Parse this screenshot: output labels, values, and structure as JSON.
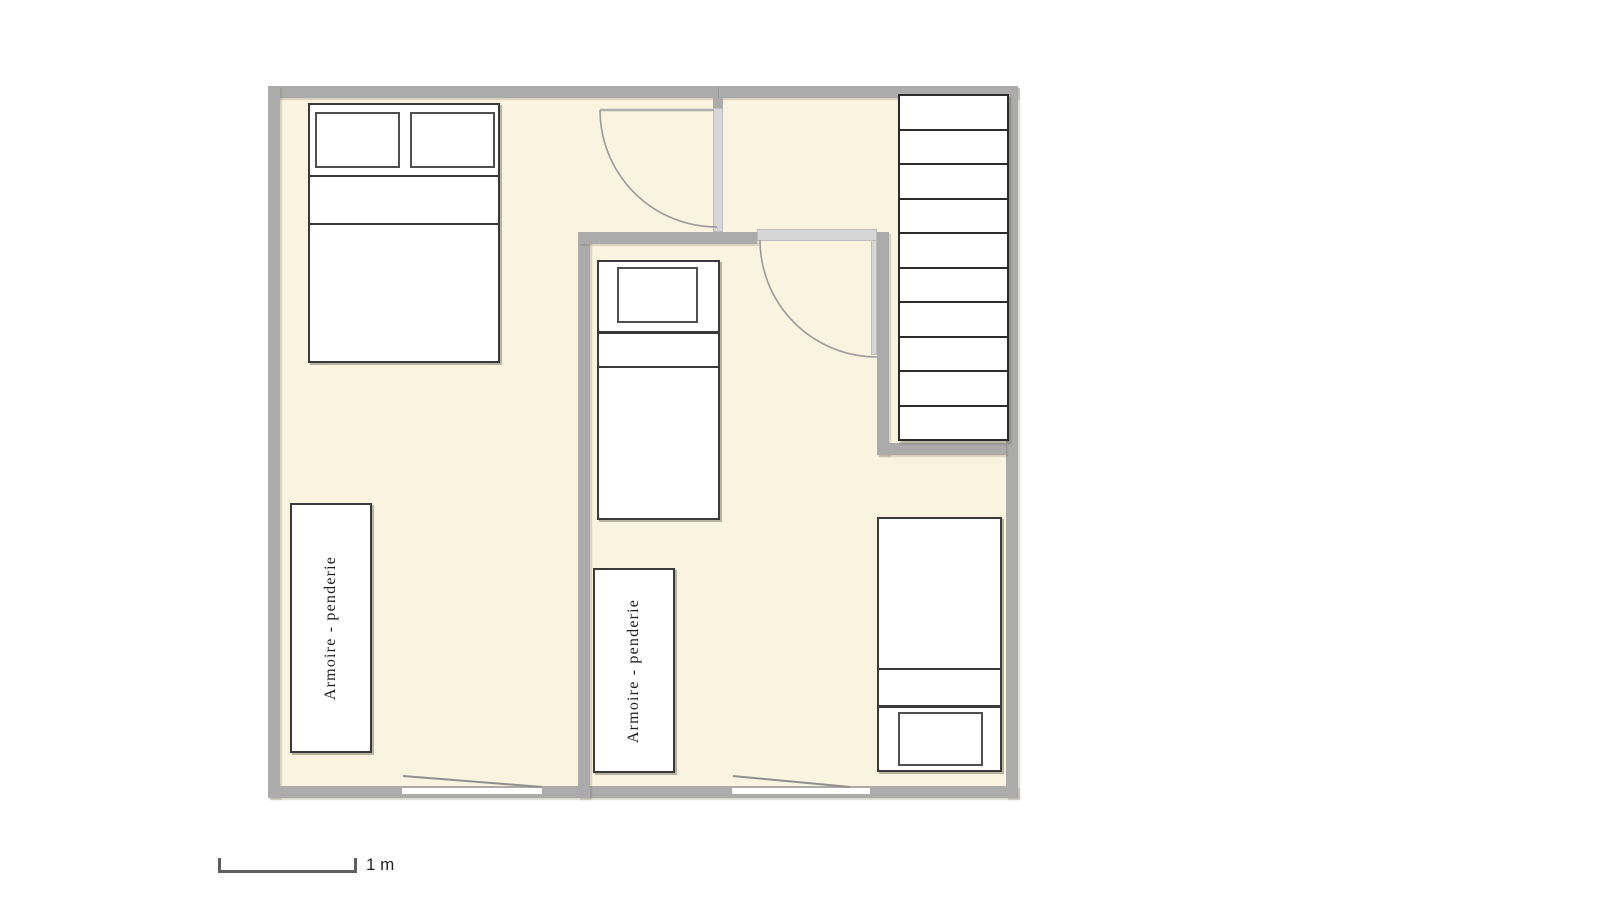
{
  "floorplan": {
    "scale": {
      "label": "1 m"
    },
    "wardrobes": [
      {
        "label": "Armoire - penderie"
      },
      {
        "label": "Armoire - penderie"
      }
    ],
    "stairs": {
      "step_count": 10
    },
    "beds": {
      "double_beds": 1,
      "single_beds": 2
    },
    "doors": {
      "swing_doors": 2,
      "bottom_wall_openings": 2
    },
    "colors": {
      "floor": "#FAF3DF",
      "wall": "#ABABAB",
      "door_leaf": "#D6D6D6",
      "furniture_outline": "#3A3A3A",
      "background": "#FFFFFF"
    }
  }
}
